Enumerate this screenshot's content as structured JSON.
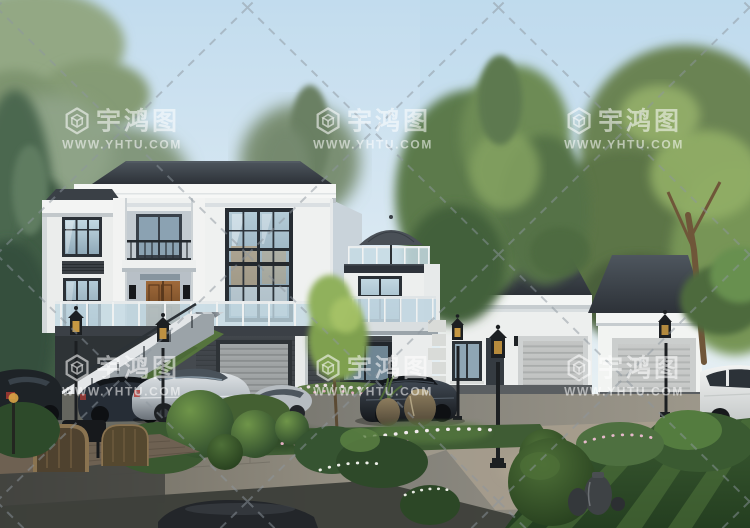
{
  "image": {
    "type": "architectural exterior rendering",
    "subject": "Two-story modern villa with roof terrace, attached single-story garage wing, exterior stone stairs, parked cars, street lanterns and landscaped garden",
    "time_of_day": "daytime, clear sky"
  },
  "watermark": {
    "brand": "宇鸿图",
    "url": "WWW.YHTU.COM",
    "logo_icon": "hexagon-cube-logo",
    "text_color": "#ffffff",
    "opacity": 0.55,
    "lattice": "dashed diagonal cross lines",
    "grid_centers_x": [
      122,
      373,
      624
    ],
    "grid_centers_y": [
      131,
      378
    ]
  },
  "palette": {
    "sky_top": "#c2dcee",
    "sky_horizon": "#eff3f1",
    "roof_dark": "#2d3238",
    "wall_white": "#f0f2f1",
    "basement_brick": "#3f4449",
    "window_frame": "#272d33",
    "glass": "#9db6c4",
    "entry_door_wood": "#7a4a26",
    "stone_wall": "#9b968a",
    "road_sunlit": "#a19b8d",
    "road_shadow": "#4a4c45",
    "foliage_dark": "#2f4d27",
    "foliage_light": "#86a364",
    "car_silver": "#b9c0c5",
    "car_dark": "#23282e",
    "car_white": "#e7e9e8",
    "lamp_black": "#1c1f22",
    "lamp_glow": "#d9a546"
  },
  "scene_elements": [
    "sky",
    "background-trees",
    "main-villa",
    "entrance-door",
    "balcony",
    "glass-curtain-wall",
    "annex-roof-terrace",
    "parasol",
    "terrace-glass-railing",
    "basement-garage-door",
    "garage-wing",
    "garage-doors",
    "exterior-stairs",
    "street-lanterns",
    "silver-sedan",
    "dark-blue-sedan",
    "dark-sedan",
    "white-suv",
    "dark-car-left",
    "dark-car-foreground",
    "stone-retaining-wall",
    "flower-bed",
    "topiary-balls",
    "lawn",
    "garden-jars",
    "rattan-chairs",
    "wood-deck"
  ]
}
